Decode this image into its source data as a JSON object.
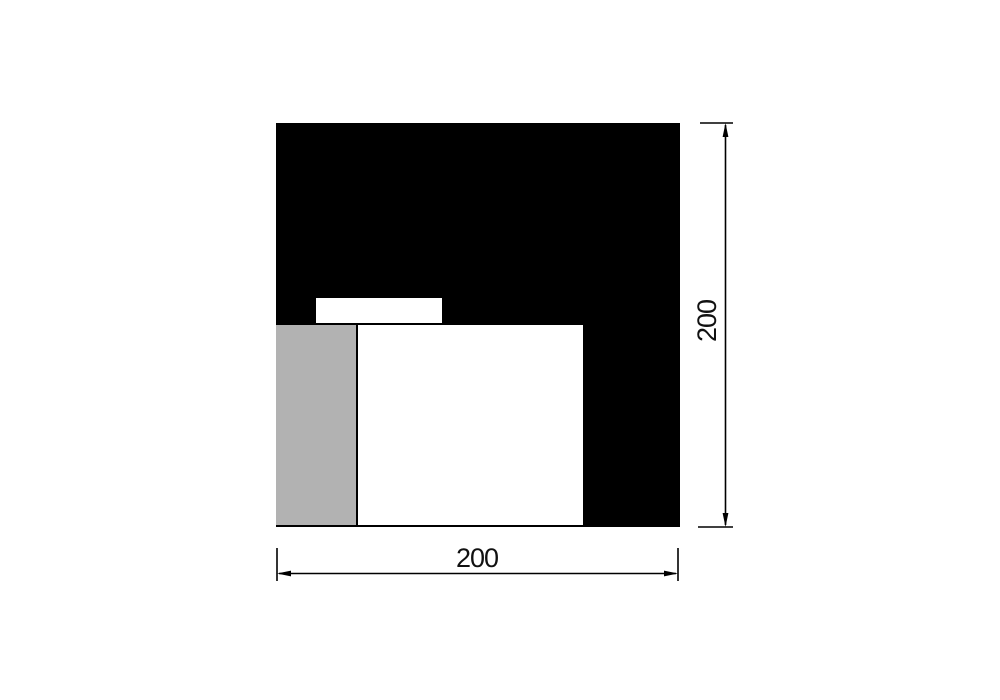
{
  "page": {
    "width": 1000,
    "height": 700,
    "background": "#ffffff"
  },
  "drawing": {
    "type": "technical-drawing",
    "stroke_color": "#000000",
    "text_color": "#111111",
    "shapes": [
      {
        "name": "outer-black-square",
        "x": 276,
        "y": 123,
        "w": 404,
        "h": 404,
        "fill": "#000000"
      },
      {
        "name": "notch-white-bar",
        "x": 316,
        "y": 298,
        "w": 126,
        "h": 25,
        "fill": "#ffffff"
      },
      {
        "name": "inner-gray-rect",
        "x": 276,
        "y": 325,
        "w": 80,
        "h": 200,
        "fill": "#b2b2b2"
      },
      {
        "name": "inner-white-rect",
        "x": 358,
        "y": 325,
        "w": 225,
        "h": 200,
        "fill": "#ffffff"
      }
    ],
    "dimensions": {
      "height": {
        "label": "200",
        "orientation": "vertical",
        "side": "right"
      },
      "width": {
        "label": "200",
        "orientation": "horizontal",
        "side": "bottom"
      }
    }
  }
}
